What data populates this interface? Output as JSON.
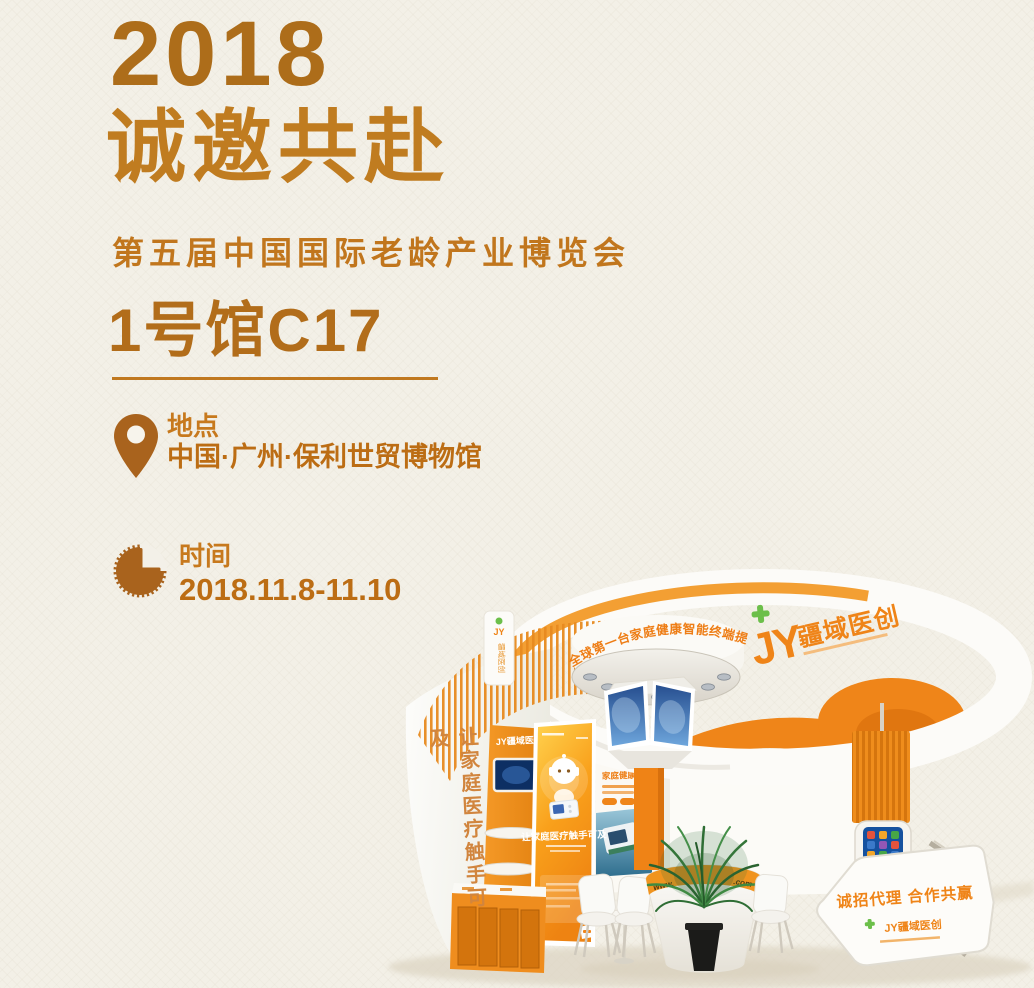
{
  "poster": {
    "year": "2018",
    "title": "诚邀共赴",
    "subtitle": "第五届中国国际老龄产业博览会",
    "hall": "1号馆C17",
    "location": {
      "label": "地点",
      "value": "中国·广州·保利世贸博物馆"
    },
    "time": {
      "label": "时间",
      "value": "2018.11.8-11.10"
    }
  },
  "booth": {
    "ring_banner": "全球第一台家庭健康智能终端提供商",
    "brand": {
      "initials": "JY",
      "name": "疆域医创"
    },
    "left_wall_slogan": "让家庭医疗触手可及",
    "column_brand": "JY疆域医创",
    "back_wall_heading": "家庭健康智能终端",
    "poster_slogan": "让家庭医疗触手可及",
    "counter_url_prefix": "www.",
    "counter_url_suffix": ".com",
    "agent_sign": {
      "headline": "诚招代理 合作共赢",
      "brand": "JY疆域医创"
    }
  },
  "colors": {
    "background": "#f3f0e7",
    "heading": "#b06e1b",
    "accent": "#c0781e",
    "booth_orange": "#ef8519",
    "logo_green": "#6cbf4a"
  }
}
